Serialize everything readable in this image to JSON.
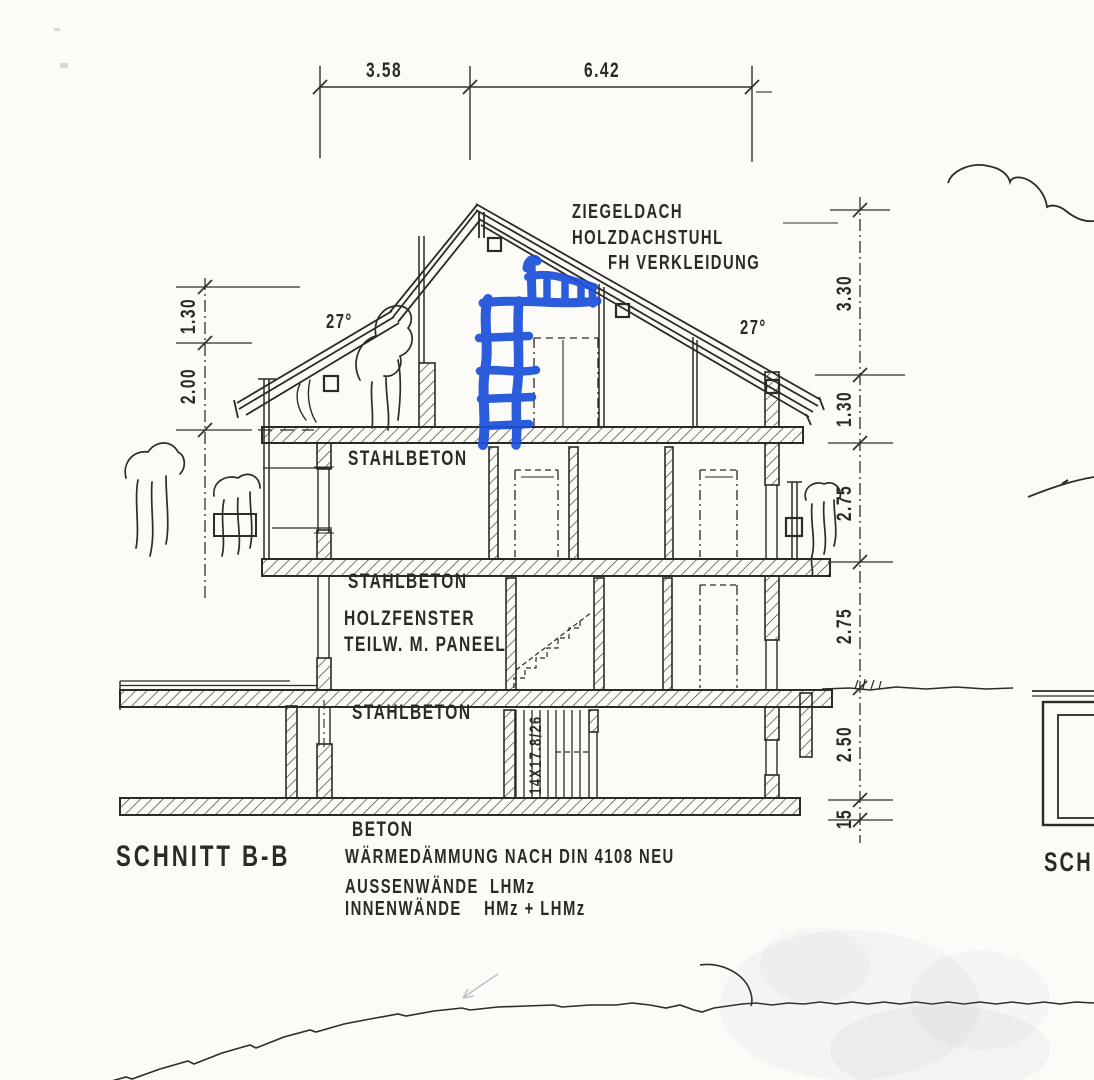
{
  "page": {
    "paper_color": "#fcfbf8",
    "ink_color": "#2d2a25",
    "annotation_color": "#1c50da"
  },
  "titles": {
    "section": "SCHNITT B-B",
    "adjacent_partial": "SCHN"
  },
  "roof": {
    "label1": "ZIEGELDACH",
    "label2": "HOLZDACHSTUHL",
    "label3": "FH VERKLEIDUNG",
    "angle_left": "27°",
    "angle_right": "27°"
  },
  "dimensions": {
    "top": {
      "d1": "3.58",
      "d2": "6.42"
    },
    "left": {
      "d1": "1.30",
      "d2": "2.00"
    },
    "right": {
      "d1": "3.30",
      "d2": "1.30",
      "d3": "2.75",
      "d4": "2.75",
      "d5": "2.50",
      "d6": "15"
    }
  },
  "materials": {
    "attic_floor": "STAHLBETON",
    "upper_floor": "STAHLBETON",
    "ground_floor": "STAHLBETON",
    "base_slab": "BETON",
    "window1": "HOLZFENSTER",
    "window2": "TEILW. M. PANEEL",
    "stair_dimension": "14X17.8/26"
  },
  "notes": {
    "n1": "WÄRMEDÄMMUNG NACH DIN 4108 NEU",
    "n2": "AUSSENWÄNDE  LHMz",
    "n3": "INNENWÄNDE    HMz + LHMz"
  },
  "annotation": {
    "type": "hand-drawn ladder with railing, blue marker",
    "color": "#1c50da"
  }
}
